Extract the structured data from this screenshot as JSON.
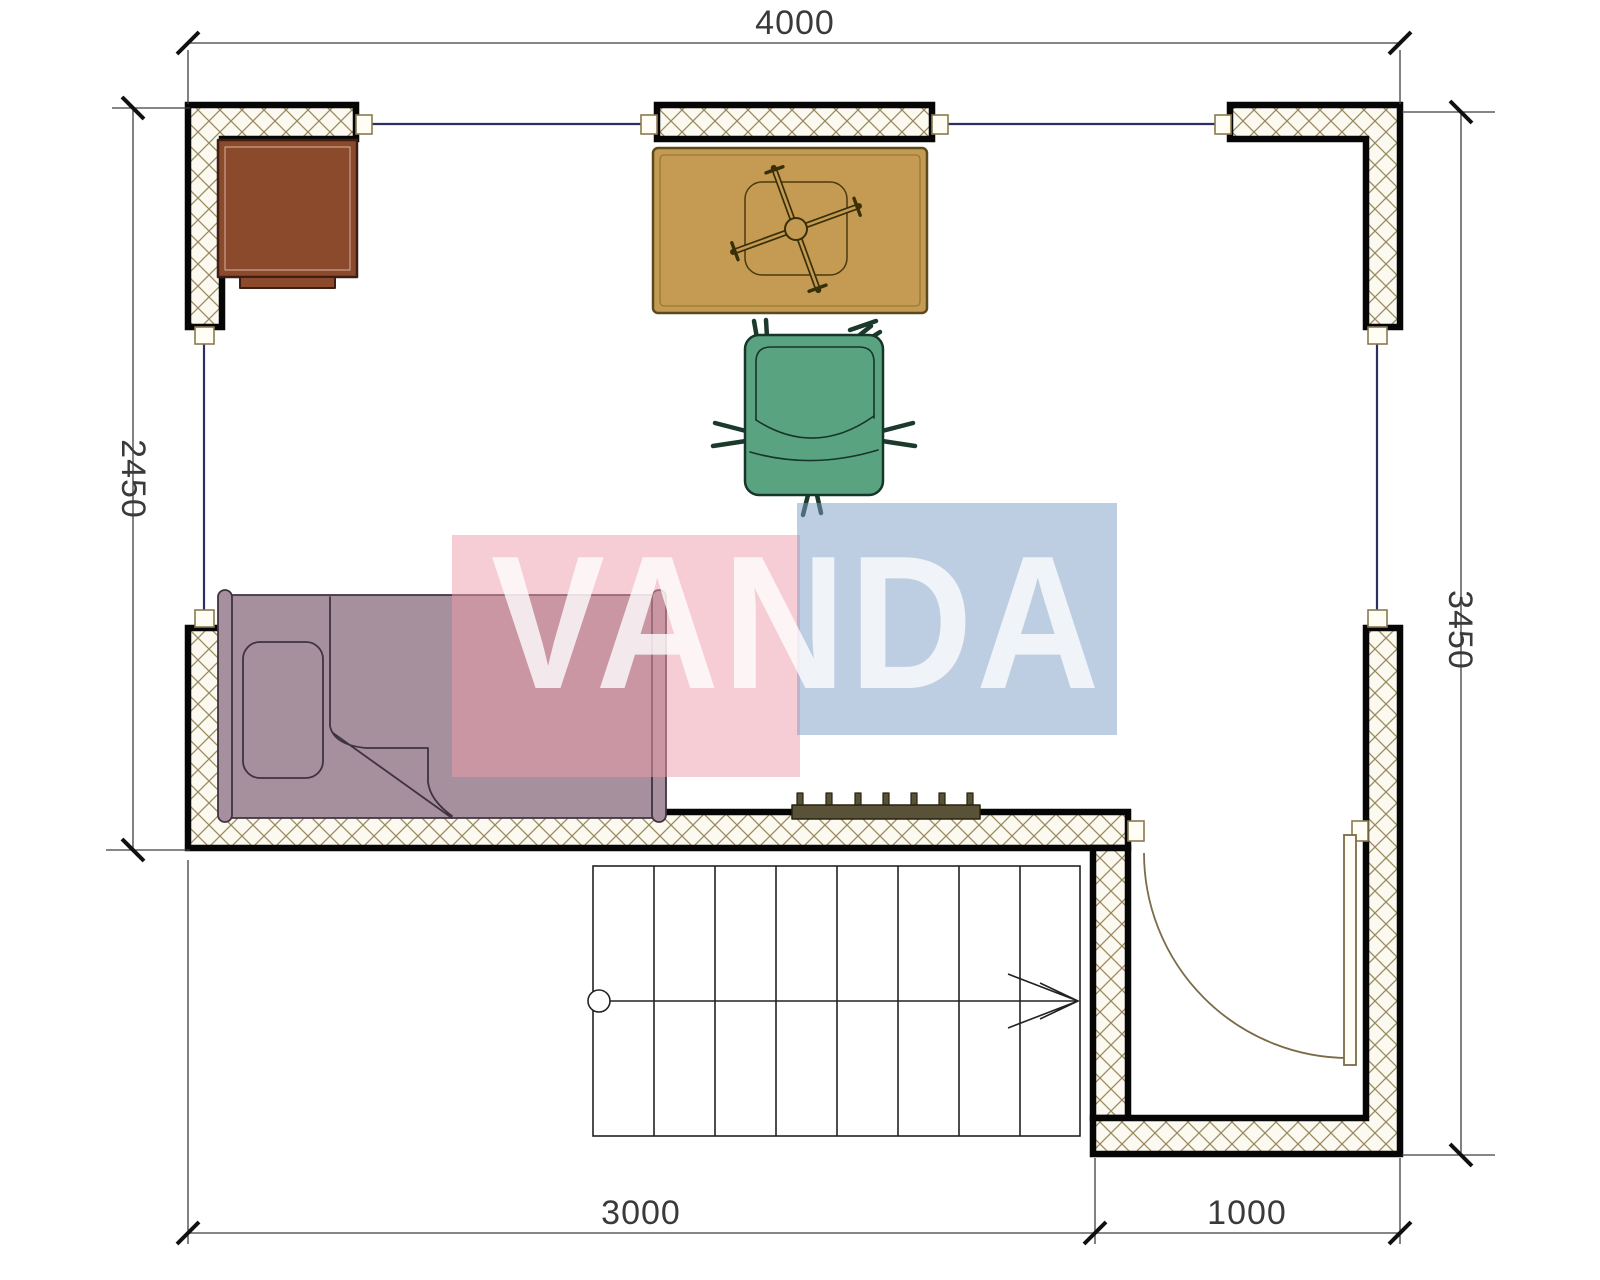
{
  "plan": {
    "type": "floor-plan",
    "watermark": {
      "text": "VANDA",
      "pink_block": "#ee9ba9",
      "blue_block": "#7e9dc6"
    },
    "dimensions": {
      "top": "4000",
      "left": "2450",
      "right": "3450",
      "bottom_left": "3000",
      "bottom_right": "1000"
    },
    "colors": {
      "wall_line": "#060606",
      "wall_hatch": "#998a5e",
      "window_line": "#2d2f5e",
      "desk": "#8b4a2b",
      "desk_stroke": "#3c1f12",
      "table": "#c59a52",
      "table_stroke": "#5a4a1e",
      "chair": "#5aa381",
      "chair_stroke": "#173528",
      "bed": "#a6909e",
      "bed_stroke": "#3f3340",
      "radiator": "#5a5238",
      "door": "#7b6b48"
    },
    "furniture": [
      {
        "name": "desk"
      },
      {
        "name": "table"
      },
      {
        "name": "office-chair"
      },
      {
        "name": "single-bed"
      },
      {
        "name": "radiator"
      },
      {
        "name": "staircase"
      },
      {
        "name": "entry-door"
      }
    ]
  }
}
